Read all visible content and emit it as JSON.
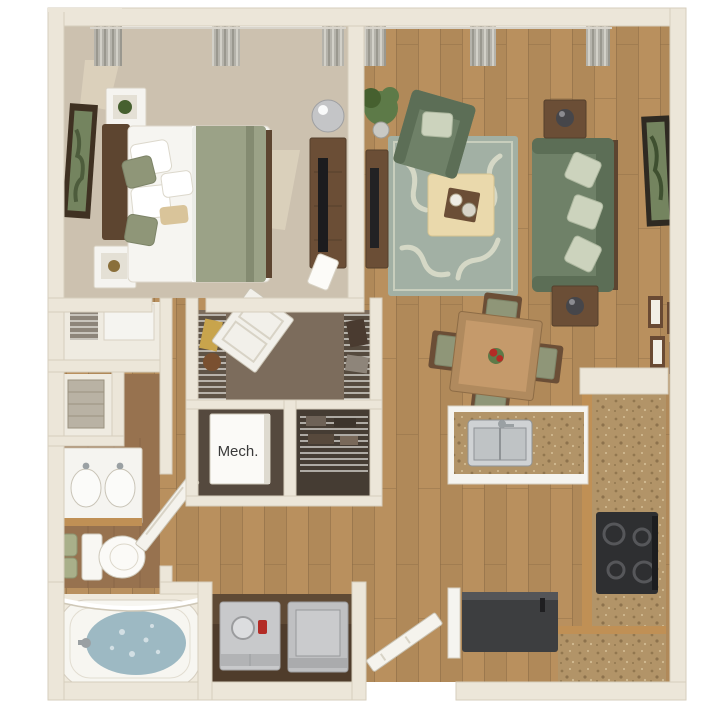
{
  "labels": {
    "mech_room": "Mech."
  },
  "colors": {
    "background": "#ffffff",
    "wall": "#ece6d9",
    "wall_edge": "#d6cebd",
    "carpet": "#ccc1af",
    "carpet_light": "#e9dfc8",
    "wood": "#b9905e",
    "wood_dark": "#8a6a45",
    "bath_floor": "#97724f",
    "closet_floor": "#7c6c5c",
    "mech_floor": "#55493e",
    "linen_white": "#f5f4f0",
    "sofa_green": "#6f8168",
    "sofa_green_dark": "#5c6e56",
    "pillow_pattern": "#ccd3bd",
    "rug": "#a2b0a4",
    "rug_pattern": "#d8dbc8",
    "ottoman": "#ead9ac",
    "duvet": "#9ba287",
    "sage_pillow": "#8f9678",
    "dark_wood": "#5d4530",
    "mid_wood": "#6b4e36",
    "granite": "#b29468",
    "cabinet": "#c09055",
    "appliance_dark": "#3d3e40",
    "appliance_gray": "#c4c5c7",
    "water": "#9db9c3",
    "curtain": "#b5b3ab",
    "frame_brown": "#6a4a33",
    "plant_green": "#5d7a48",
    "plant_green_dark": "#46602f",
    "accent_red": "#b32b25",
    "towel_green": "#a9b08a",
    "art_green": "#74845f",
    "throw_tan": "#d9c49a",
    "text_dark": "#3a3a3a"
  }
}
